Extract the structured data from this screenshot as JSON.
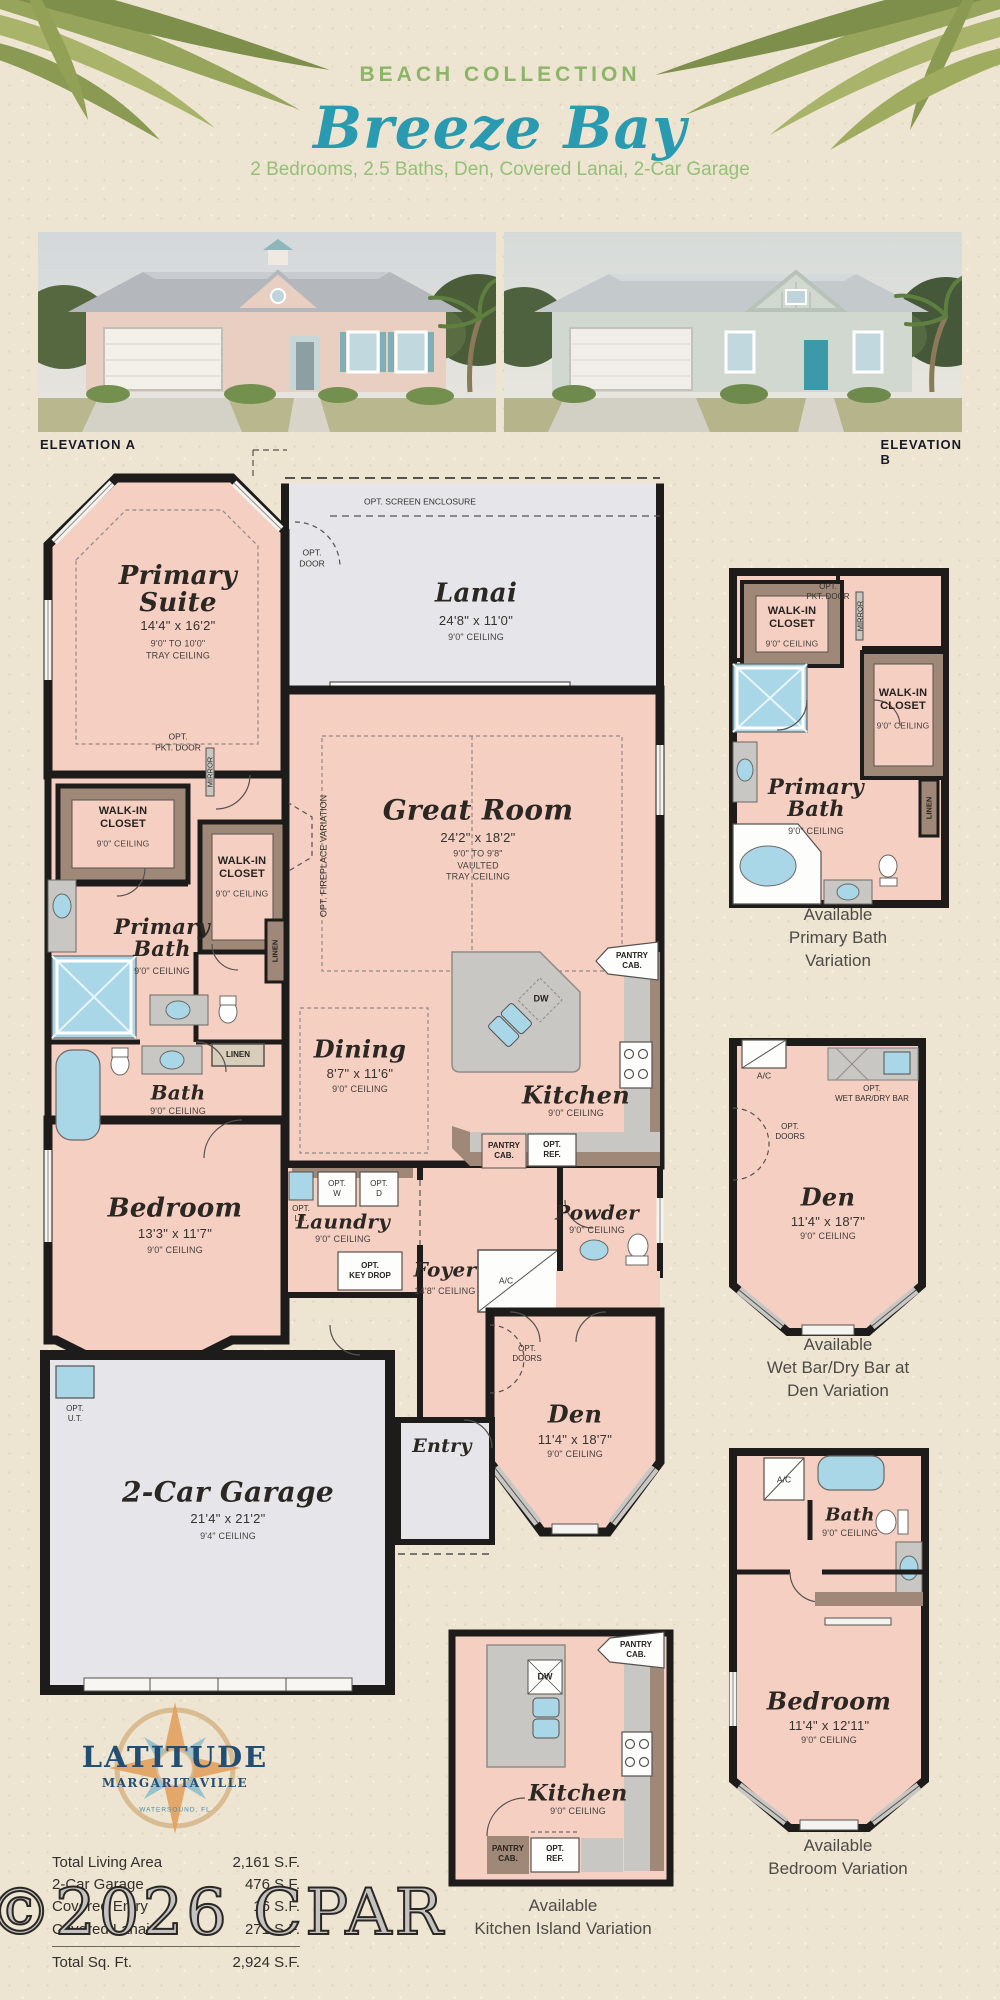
{
  "page": {
    "title_kicker": "BEACH COLLECTION",
    "title": "Breeze Bay",
    "subtitle": "2 Bedrooms, 2.5 Baths, Den, Covered Lanai, 2-Car Garage"
  },
  "elevations": {
    "a_label": "ELEVATION A",
    "b_label": "ELEVATION B"
  },
  "plan": {
    "rooms": {
      "primary_suite": {
        "name": "Primary\nSuite",
        "dims": "14'4\" x 16'2\"",
        "ceiling": "9'0\" TO 10'0\"\nTRAY CEILING"
      },
      "lanai": {
        "name": "Lanai",
        "dims": "24'8\" x 11'0\"",
        "ceiling": "9'0\" CEILING"
      },
      "great_room": {
        "name": "Great Room",
        "dims": "24'2\" x 18'2\"",
        "ceiling": "9'0\" TO 9'8\"\nVAULTED\nTRAY CEILING"
      },
      "walk_in_closet": {
        "name": "WALK-IN\nCLOSET",
        "ceiling": "9'0\" CEILING"
      },
      "primary_bath": {
        "name": "Primary\nBath",
        "ceiling": "9'0\" CEILING"
      },
      "bath": {
        "name": "Bath",
        "ceiling": "9'0\" CEILING"
      },
      "bedroom": {
        "name": "Bedroom",
        "dims": "13'3\" x 11'7\"",
        "ceiling": "9'0\" CEILING"
      },
      "dining": {
        "name": "Dining",
        "dims": "8'7\" x 11'6\"",
        "ceiling": "9'0\" CEILING"
      },
      "kitchen": {
        "name": "Kitchen",
        "ceiling": "9'0\" CEILING"
      },
      "laundry": {
        "name": "Laundry",
        "ceiling": "9'0\" CEILING"
      },
      "powder": {
        "name": "Powder",
        "ceiling": "9'0\" CEILING"
      },
      "foyer": {
        "name": "Foyer",
        "ceiling": "14'8\" CEILING"
      },
      "entry": {
        "name": "Entry"
      },
      "den": {
        "name": "Den",
        "dims": "11'4\" x 18'7\"",
        "ceiling": "9'0\" CEILING"
      },
      "garage": {
        "name": "2-Car Garage",
        "dims": "21'4\" x 21'2\"",
        "ceiling": "9'4\" CEILING"
      }
    },
    "labels": {
      "opt_screen_enclosure": "OPT. SCREEN ENCLOSURE",
      "opt_door": "OPT.\nDOOR",
      "opt_pkt_door": "OPT.\nPKT. DOOR",
      "mirror": "MIRROR",
      "opt_fireplace": "OPT. FIREPLACE VARIATION",
      "linen": "LINEN",
      "pantry_cab": "PANTRY\nCAB.",
      "opt_ref": "OPT.\nREF.",
      "dw": "DW",
      "opt_w": "OPT.\nW",
      "opt_d": "OPT.\nD",
      "opt_lt": "OPT.\nL.T.",
      "opt_key_drop": "OPT.\nKEY DROP",
      "ac": "A/C",
      "opt_doors": "OPT.\nDOORS",
      "opt_ut": "OPT.\nU.T.",
      "opt_wet_bar": "OPT.\nWET BAR/DRY BAR"
    }
  },
  "variations": {
    "primary_bath": {
      "caption": "Available\nPrimary Bath Variation"
    },
    "den": {
      "caption": "Available\nWet Bar/Dry Bar at Den Variation"
    },
    "bedroom": {
      "caption": "Available\nBedroom Variation",
      "name": "Bedroom",
      "dims": "11'4\" x 12'11\"",
      "ceiling": "9'0\" CEILING"
    },
    "kitchen_island": {
      "caption": "Available\nKitchen Island Variation"
    }
  },
  "logo": {
    "line1": "LATITUDE",
    "line2": "MARGARITAVILLE",
    "location": "WATERSOUND, FL"
  },
  "totals": {
    "rows": [
      {
        "label": "Total Living Area",
        "value": "2,161 S.F."
      },
      {
        "label": "2-Car Garage",
        "value": "476 S.F."
      },
      {
        "label": "Covered Entry",
        "value": "16 S.F."
      },
      {
        "label": "Covered Lanai",
        "value": "271 S.F."
      }
    ],
    "total": {
      "label": "Total Sq. Ft.",
      "value": "2,924 S.F."
    }
  },
  "watermark": "©2026 CPAR",
  "colors": {
    "header_green": "#8CB568",
    "title_teal": "#2A9AB0",
    "subtitle_green": "#95BF78",
    "room_pink": "#F6CFC3",
    "floor_gray": "#E6E6EA",
    "closet_taupe": "#A08878",
    "fixture_blue": "#A9D7E8",
    "wall": "#1D1C1A",
    "sand": "#EDE5D2",
    "logo_blue": "#234E74",
    "compass_orange": "#E2A05E"
  }
}
